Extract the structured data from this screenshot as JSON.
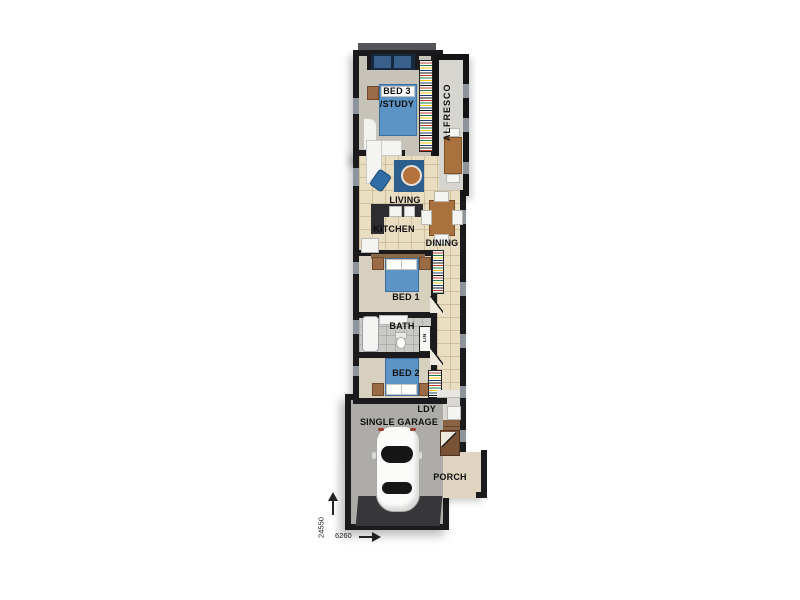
{
  "image_type": "architectural-floor-plan",
  "rooms": {
    "bed3": {
      "label_line1": "BED 3",
      "label_line2": "/STUDY"
    },
    "alfresco": {
      "label": "ALFRESCO"
    },
    "living": {
      "label": "LIVING"
    },
    "kitchen": {
      "label": "KITCHEN"
    },
    "dining": {
      "label": "DINING"
    },
    "bed1": {
      "label": "BED 1"
    },
    "bath": {
      "label": "BATH"
    },
    "linen": {
      "label": "LIN"
    },
    "bed2": {
      "label": "BED 2"
    },
    "laundry": {
      "label": "LDY"
    },
    "garage": {
      "label": "SINGLE GARAGE"
    },
    "porch": {
      "label": "PORCH"
    }
  },
  "dimensions": {
    "depth_mm": "24550",
    "width_mm": "6260"
  },
  "colors": {
    "wall": "#1b1b1d",
    "tile_floor": "#e9ddc2",
    "carpet": "#d7d0bf",
    "bed_blue": "#5b94c5",
    "rug_blue": "#2d5f8e",
    "timber": "#a9713d",
    "entry_timber": "#8a6242",
    "concrete": "#aeaca8",
    "driveway_apron": "#37373a",
    "bath_tile": "#c9c9c6",
    "alfresco_floor": "#d7d5d0",
    "porch_floor": "#ded4c0",
    "counter_dark": "#2c2c31",
    "window_grey": "#8d949b"
  }
}
